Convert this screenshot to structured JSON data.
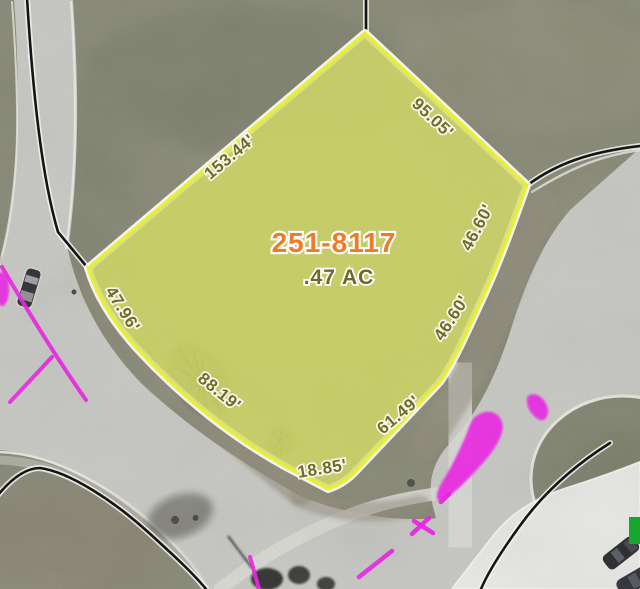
{
  "map": {
    "view": "aerial-parcel-highlight",
    "parcel": {
      "id": "251-8117",
      "area": ".47 AC",
      "dimensions": [
        {
          "text": "153.44'"
        },
        {
          "text": "95.05'"
        },
        {
          "text": "46.60'"
        },
        {
          "text": "46.60'"
        },
        {
          "text": "61.49'"
        },
        {
          "text": "18.85'"
        },
        {
          "text": "88.19'"
        },
        {
          "text": "47.96'"
        }
      ]
    },
    "colors": {
      "grass": "#82836f",
      "road": "#c6c7c2",
      "concrete": "#e9eae6",
      "parcel_fill": "#d4da66",
      "parcel_border": "#e9f02f",
      "dimension_text": "#6f6d26",
      "parcel_id_text": "#ee7b28",
      "area_text": "#696b2c",
      "utility_paint": "#ee14e6",
      "boundary_line": "#141414",
      "sign_green": "#14a92e"
    }
  }
}
